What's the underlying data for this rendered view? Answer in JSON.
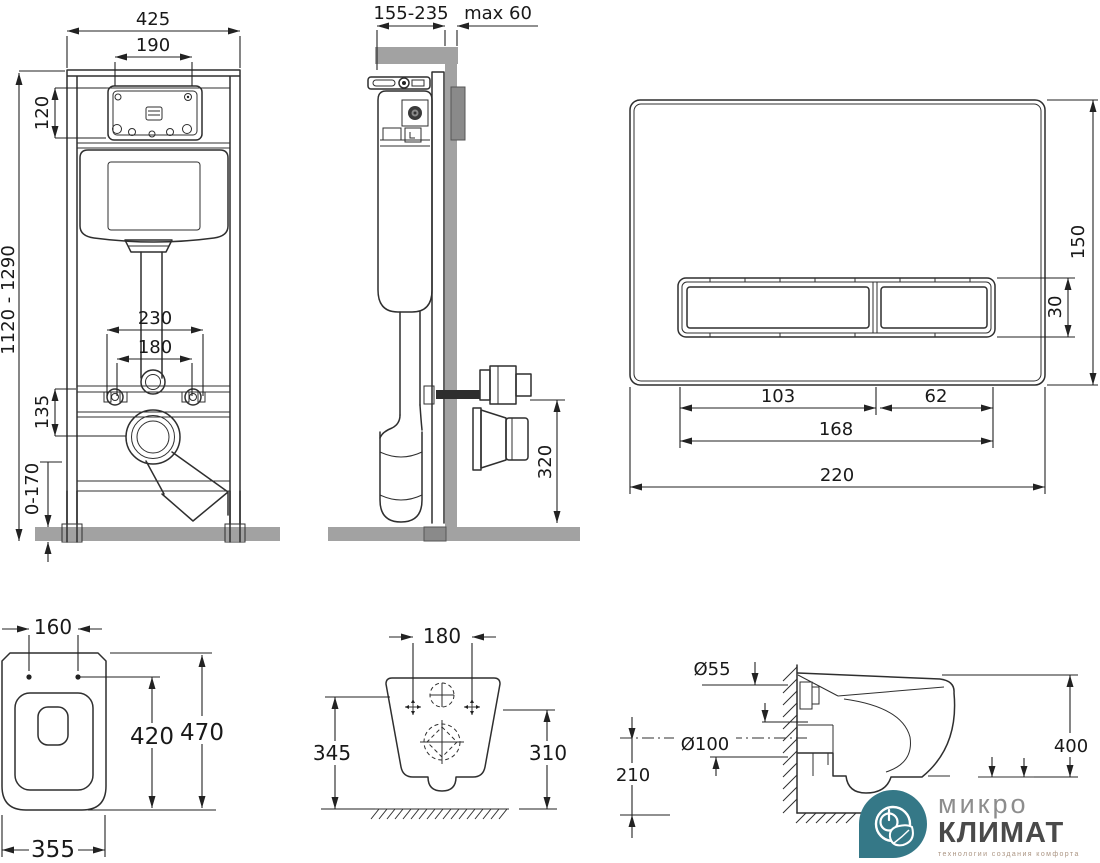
{
  "colors": {
    "line": "#2f2f2f",
    "dimension_text": "#191919",
    "wall_floor_gray": "#a2a2a2",
    "housing_gray": "#8a8a8a",
    "logo_teal": "#357887",
    "logo_name_light": "#8d8d8d",
    "logo_name_dark": "#4a4a4a",
    "logo_tagline": "#ab9583"
  },
  "frame_front": {
    "width": "425",
    "window_width": "190",
    "window_height": "120",
    "height_range": "1120 - 1290",
    "rod_spacing": "230",
    "bolt_spacing": "180",
    "outlet_drop": "135",
    "leg_adjust": "0-170"
  },
  "frame_side": {
    "depth_range": "155-235",
    "wall_max": "max 60",
    "outlet_height": "320"
  },
  "flush_plate": {
    "height": "150",
    "button_height": "30",
    "left_button_width": "103",
    "right_button_width": "62",
    "buttons_width": "168",
    "width": "220"
  },
  "bowl_top": {
    "hole_spacing": "160",
    "length": "470",
    "inner_length": "420",
    "width": "355"
  },
  "bowl_rear": {
    "bolt_spacing": "180",
    "height_left": "345",
    "height_right": "310"
  },
  "bowl_side": {
    "inlet_diameter": "Ø55",
    "outlet_diameter": "Ø100",
    "outlet_center_height": "210",
    "rim_height": "400"
  },
  "logo": {
    "line1": "микро",
    "line2": "КЛИМАТ",
    "tagline": "технологии создания комфорта"
  }
}
